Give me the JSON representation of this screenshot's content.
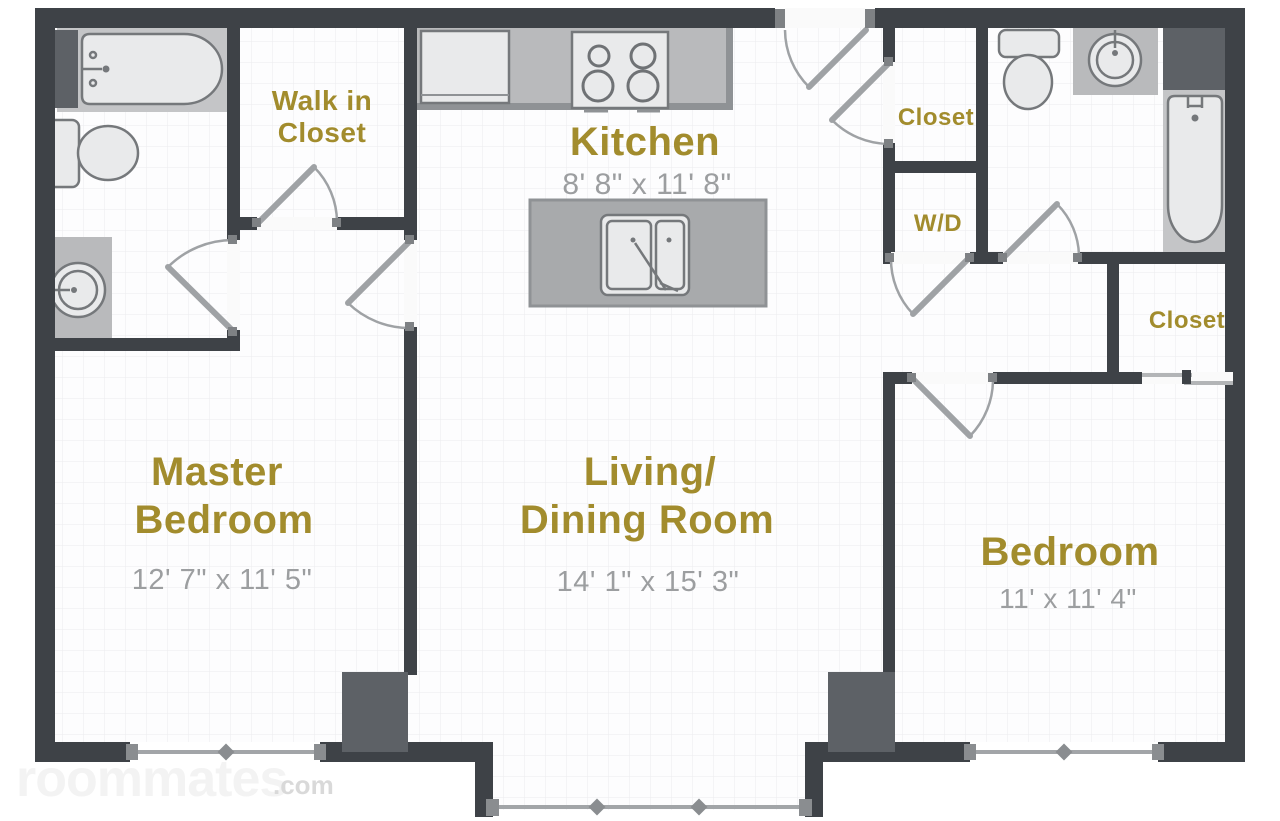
{
  "colors": {
    "wall": "#3e4247",
    "pillar": "#5d6166",
    "room_label": "#a28c2d",
    "dimension_text": "#9c9ea0",
    "counter": "#b9babc",
    "island": "#a8aaac",
    "fixture_fill": "#e9eaeb",
    "fixture_stroke": "#75787b",
    "door": "#9fa2a5",
    "window": "#8a8d90",
    "watermark": "#f3f3f3",
    "watermark_tld": "#d8d8d8"
  },
  "watermark": {
    "name": "roommates",
    "tld": ".com"
  },
  "rooms": {
    "kitchen": {
      "label": "Kitchen",
      "dims": "8' 8\" x 11' 8\""
    },
    "walk_in_closet": {
      "line1": "Walk in",
      "line2": "Closet"
    },
    "hall_closet": {
      "label": "Closet"
    },
    "laundry": {
      "label": "W/D"
    },
    "master_bedroom": {
      "line1": "Master",
      "line2": "Bedroom",
      "dims": "12' 7\" x 11' 5\""
    },
    "living_dining": {
      "line1": "Living/",
      "line2": "Dining Room",
      "dims": "14' 1\" x 15' 3\""
    },
    "bedroom": {
      "label": "Bedroom",
      "dims": "11' x 11' 4\""
    },
    "bedroom_closet": {
      "label": "Closet"
    }
  },
  "fixtures": [
    "bathtub",
    "toilet",
    "sink",
    "refrigerator",
    "stove",
    "kitchen-island",
    "island-sink",
    "closet-sliding-door",
    "washer-dryer-space"
  ]
}
